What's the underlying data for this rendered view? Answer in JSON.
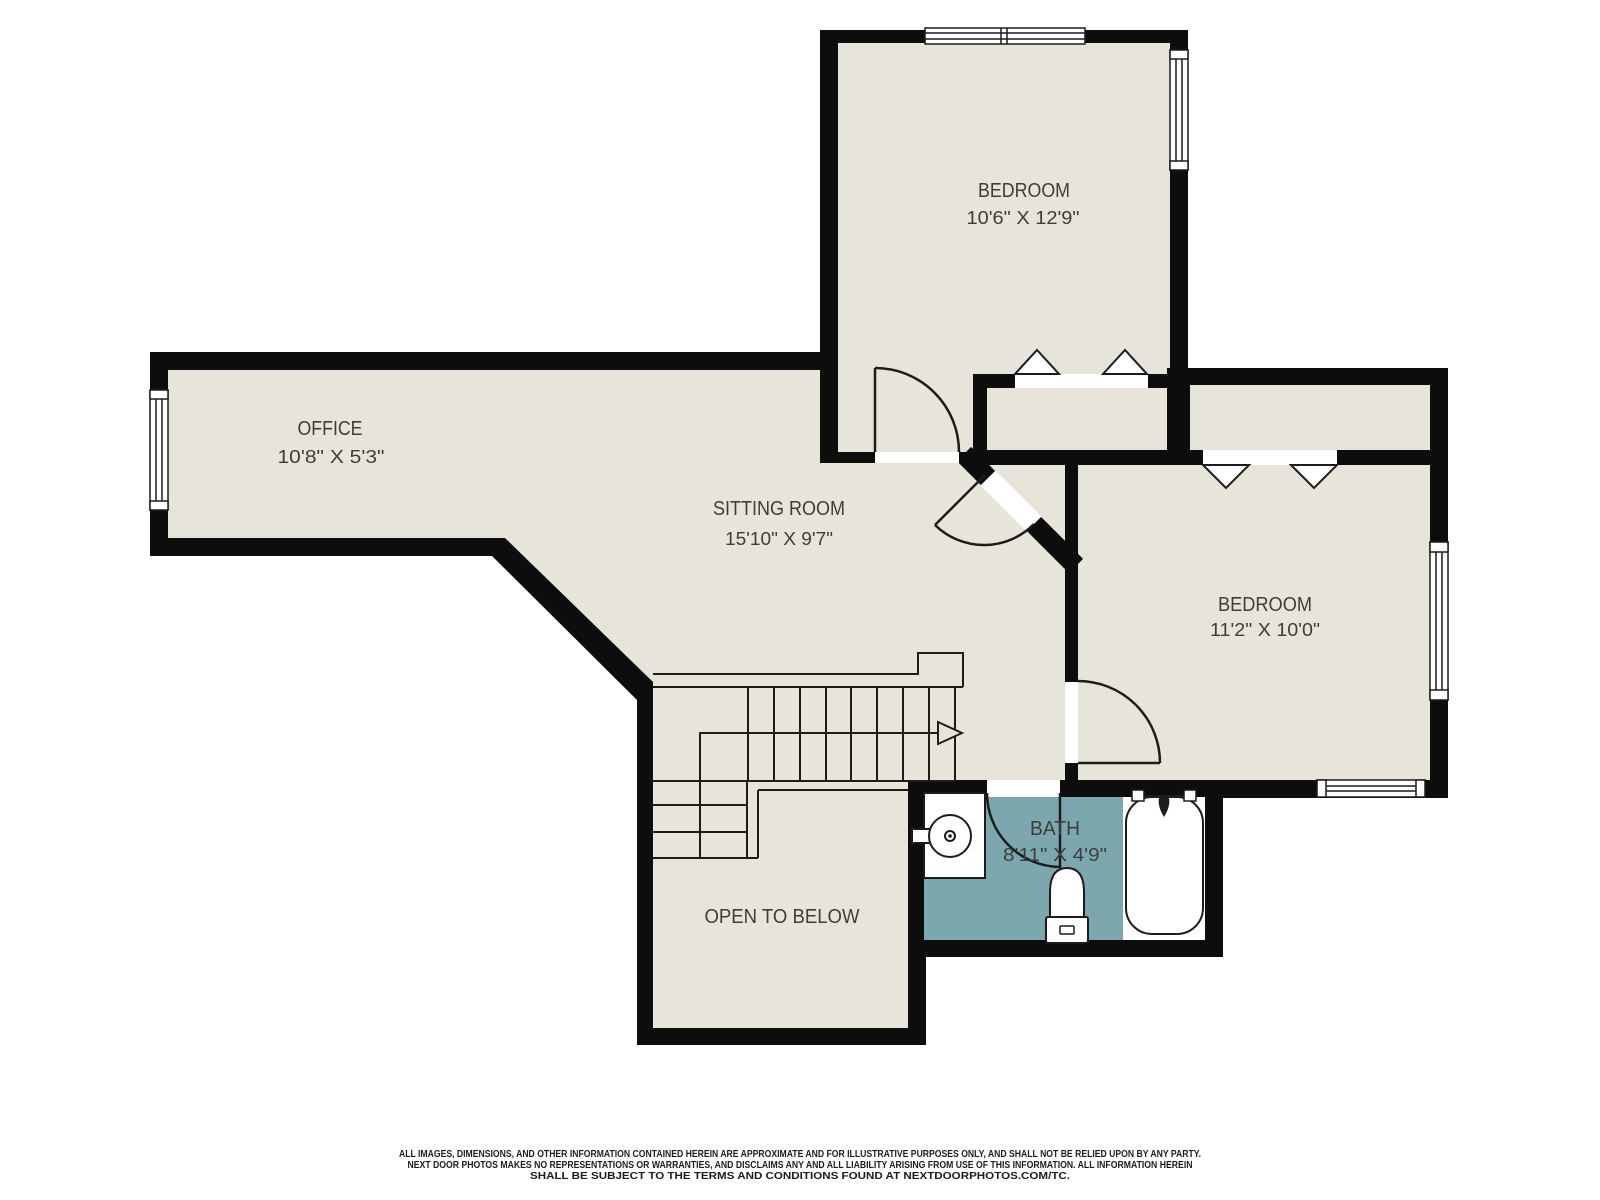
{
  "rooms": {
    "bedroom_top": {
      "label": "BEDROOM",
      "dims": "10'6\" X 12'9\""
    },
    "office": {
      "label": "OFFICE",
      "dims": "10'8\" X 5'3\""
    },
    "sitting_room": {
      "label": "SITTING ROOM",
      "dims": "15'10\" X 9'7\""
    },
    "bedroom_right": {
      "label": "BEDROOM",
      "dims": "11'2\" X 10'0\""
    },
    "bath": {
      "label": "BATH",
      "dims": "8'11\" X 4'9\""
    },
    "open_to_below": {
      "label": "OPEN TO BELOW"
    }
  },
  "colors": {
    "background": "#ffffff",
    "floor": "#e7e5da",
    "wall": "#0d0d0d",
    "bath_floor": "#7da7af",
    "line": "#1c1c1c",
    "label_text": "#3e3d39",
    "disclaimer_text": "#1c1c1c"
  },
  "disclaimer": {
    "line1": "ALL IMAGES, DIMENSIONS, AND OTHER INFORMATION CONTAINED HEREIN ARE APPROXIMATE AND FOR ILLUSTRATIVE PURPOSES ONLY, AND SHALL NOT BE RELIED UPON BY ANY PARTY.",
    "line2": "NEXT DOOR PHOTOS MAKES NO REPRESENTATIONS OR WARRANTIES, AND DISCLAIMS ANY AND ALL LIABILITY ARISING FROM USE OF THIS INFORMATION. ALL INFORMATION HEREIN",
    "line3": "SHALL BE SUBJECT TO THE TERMS AND CONDITIONS FOUND AT NEXTDOORPHOTOS.COM/TC."
  }
}
